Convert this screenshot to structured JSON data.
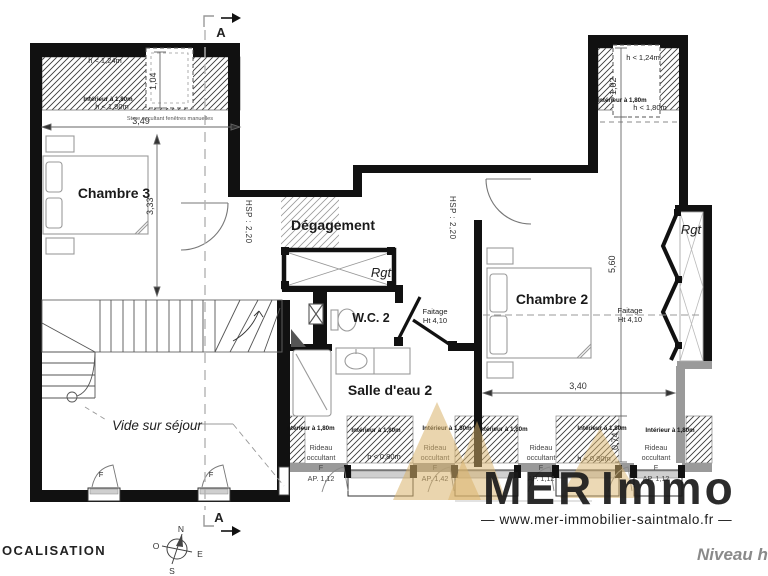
{
  "rooms": {
    "chambre3": "Chambre 3",
    "degagement": "Dégagement",
    "wc2": "W.C. 2",
    "salle_deau2": "Salle d'eau 2",
    "chambre2": "Chambre 2",
    "vide_sur_sejour": "Vide sur séjour",
    "rgt": "Rgt"
  },
  "dimensions": {
    "top_left_width": "3,49",
    "chambre3_height": "3,33",
    "left_window": "1,04",
    "right_window": "1,02",
    "chambre2_height": "5,60",
    "chambre2_width": "3,40",
    "bottom_window": "0,74"
  },
  "ceiling": {
    "hsp": "HSP : 2,20",
    "faitage": "Faitage",
    "faitage_ht": "Ht 4,10"
  },
  "roof_notes": {
    "h_124": "h < 1,24m",
    "interieur_180": "Intérieur à 1,80m",
    "h_180": "h < 1,80m",
    "h_080": "h < 0,80m",
    "store": "Store occultant fenêtres manuelles"
  },
  "openings": {
    "rideau_line1": "Rideau",
    "rideau_line2": "occultant",
    "window_f": "F",
    "ap_112": "AP. 1,12",
    "ap_142": "AP. 1,42"
  },
  "section": {
    "label": "A"
  },
  "compass": {
    "n": "N",
    "o": "O",
    "e": "E",
    "s": "S"
  },
  "footer": {
    "localisation": "OCALISATION",
    "level": "Niveau ha"
  },
  "watermark": {
    "brand_1": "MER",
    "brand_2": "Immo",
    "url": "— www.mer-immobilier-saintmalo.fr —",
    "brand_gray": "#9b9b9b",
    "brand_gold": "#c9a366"
  }
}
